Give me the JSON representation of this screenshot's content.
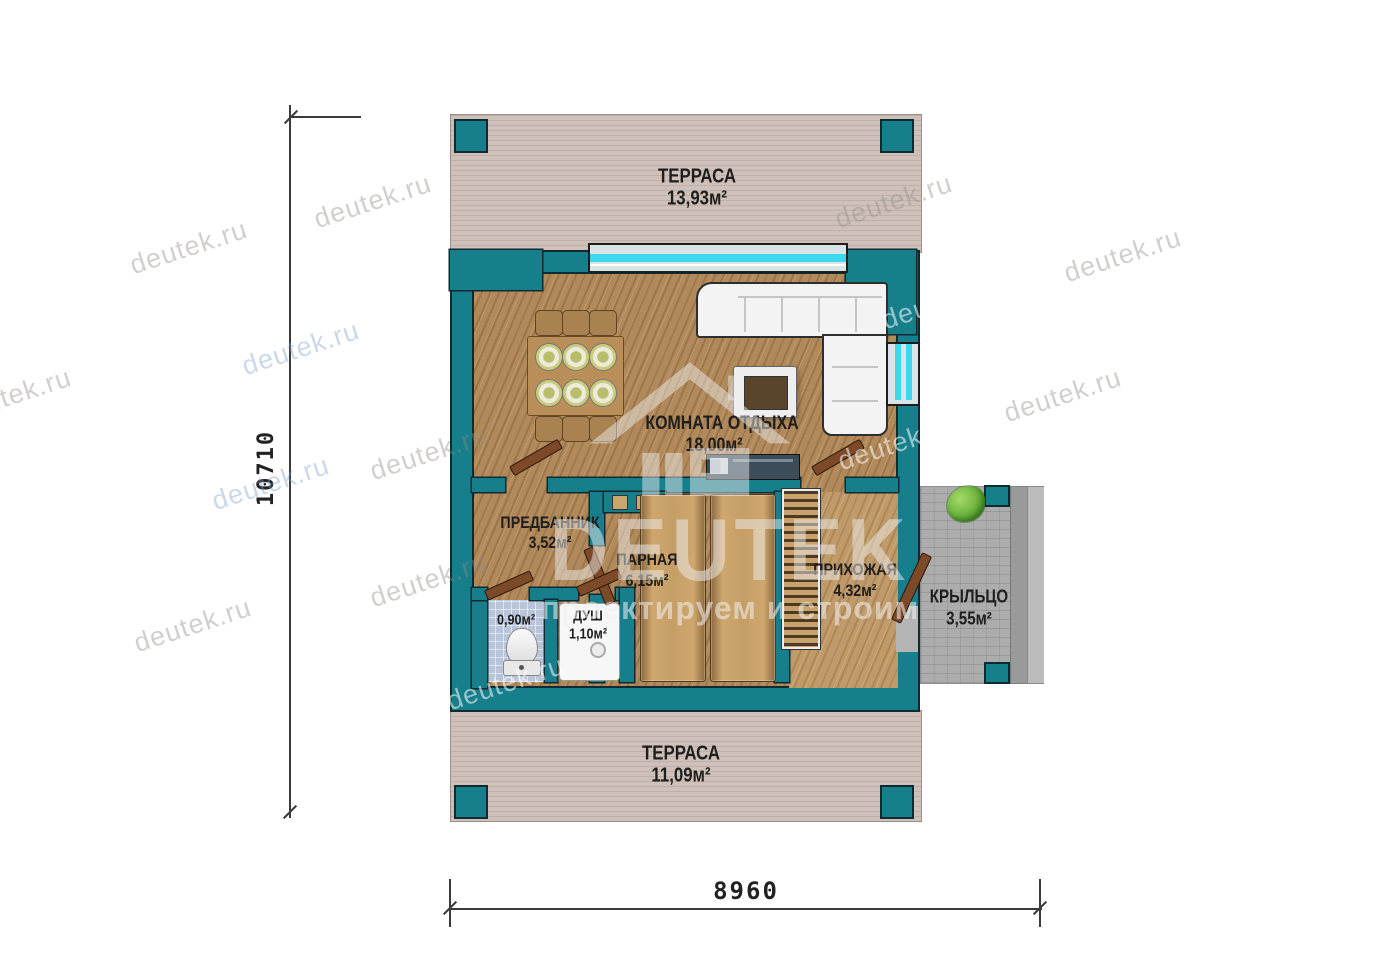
{
  "watermark": {
    "brand": "DEUTEK",
    "tagline": "проектируем и строим",
    "url": "deutek.ru"
  },
  "dimensions": {
    "vertical": "10710",
    "horizontal": "8960"
  },
  "rooms": {
    "terrace_top": {
      "name": "ТЕРРАСА",
      "area": "13,93м²"
    },
    "rest_room": {
      "name": "КОМНАТА ОТДЫХА",
      "area": "18,00м²"
    },
    "predbannik": {
      "name": "ПРЕДБАННИК",
      "area": "3,52м²"
    },
    "parnaya": {
      "name": "ПАРНАЯ",
      "area": "6,15м²"
    },
    "hallway": {
      "name": "ПРИХОЖАЯ",
      "area": "4,32м²"
    },
    "porch": {
      "name": "КРЫЛЬЦО",
      "area": "3,55м²"
    },
    "wc": {
      "area": "0,90м²"
    },
    "shower": {
      "name": "ДУШ",
      "area": "1,10м²"
    },
    "terrace_bottom": {
      "name": "ТЕРРАСА",
      "area": "11,09м²"
    }
  },
  "colors": {
    "wall_teal": "#177e8c",
    "wood_floor": "#b1895a",
    "terrace_deck": "#cfc1b9",
    "porch_stone": "#acacac",
    "window_glass": "#3fd7ea",
    "door_wood": "#7c4a28",
    "wc_tile": "#b7c4da",
    "outline": "#0d2b31"
  }
}
